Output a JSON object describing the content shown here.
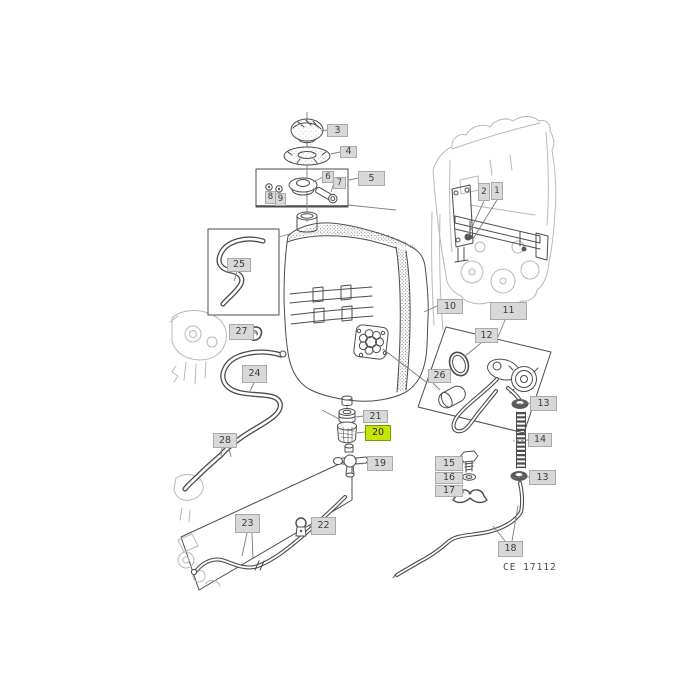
{
  "diagram": {
    "type": "exploded-parts-diagram",
    "subject": "fuel-tank-assembly",
    "image_code": "CE  17112",
    "selected_part": "20",
    "colors": {
      "callout_bg": "#d8d8d8",
      "callout_border": "#a9a9a9",
      "callout_text": "#3c3c3c",
      "highlight_bg": "#c9e30a",
      "highlight_border": "#6f9b05",
      "highlight_text": "#1c2a00",
      "line_dark": "#4c4c4c",
      "line_faded": "#b8b8b8",
      "leader": "#7e7e7e"
    },
    "callouts": [
      {
        "part": "3"
      },
      {
        "part": "4"
      },
      {
        "part": "5"
      },
      {
        "part": "6"
      },
      {
        "part": "7"
      },
      {
        "part": "8"
      },
      {
        "part": "9"
      },
      {
        "part": "1"
      },
      {
        "part": "2"
      },
      {
        "part": "10"
      },
      {
        "part": "11"
      },
      {
        "part": "12"
      },
      {
        "part": "26"
      },
      {
        "part": "25"
      },
      {
        "part": "27"
      },
      {
        "part": "24"
      },
      {
        "part": "28"
      },
      {
        "part": "23"
      },
      {
        "part": "22"
      },
      {
        "part": "21"
      },
      {
        "part": "20"
      },
      {
        "part": "19"
      },
      {
        "part": "13"
      },
      {
        "part": "14"
      },
      {
        "part": "13"
      },
      {
        "part": "15"
      },
      {
        "part": "16"
      },
      {
        "part": "17"
      },
      {
        "part": "18"
      }
    ]
  }
}
